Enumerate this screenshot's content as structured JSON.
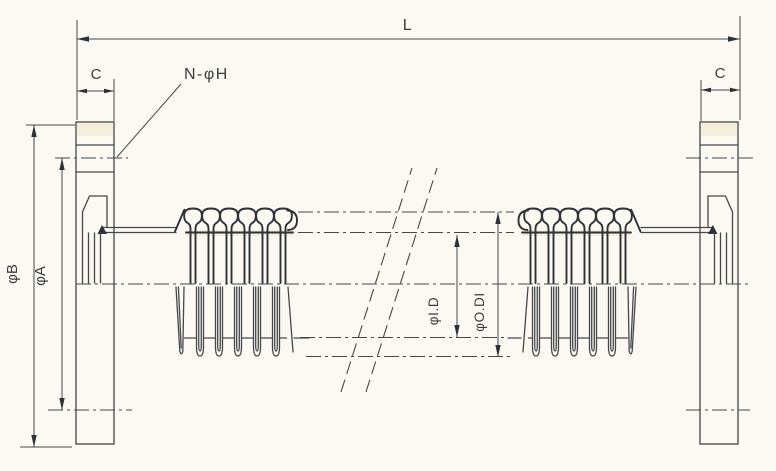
{
  "drawing": {
    "labels": {
      "overall_length": "L",
      "flange_thickness_left": "C",
      "flange_thickness_right": "C",
      "bolt_hole_callout": "N-φH",
      "flange_outer_diameter": "φB",
      "bolt_circle_diameter": "φA",
      "inner_diameter": "φI.D",
      "outer_diameter": "φO.DI"
    },
    "colors": {
      "background": "#fbf9f1",
      "line": "#45474d",
      "dark": "#2e3237",
      "text": "#3a3c40",
      "tint": "#efe8c8"
    }
  }
}
